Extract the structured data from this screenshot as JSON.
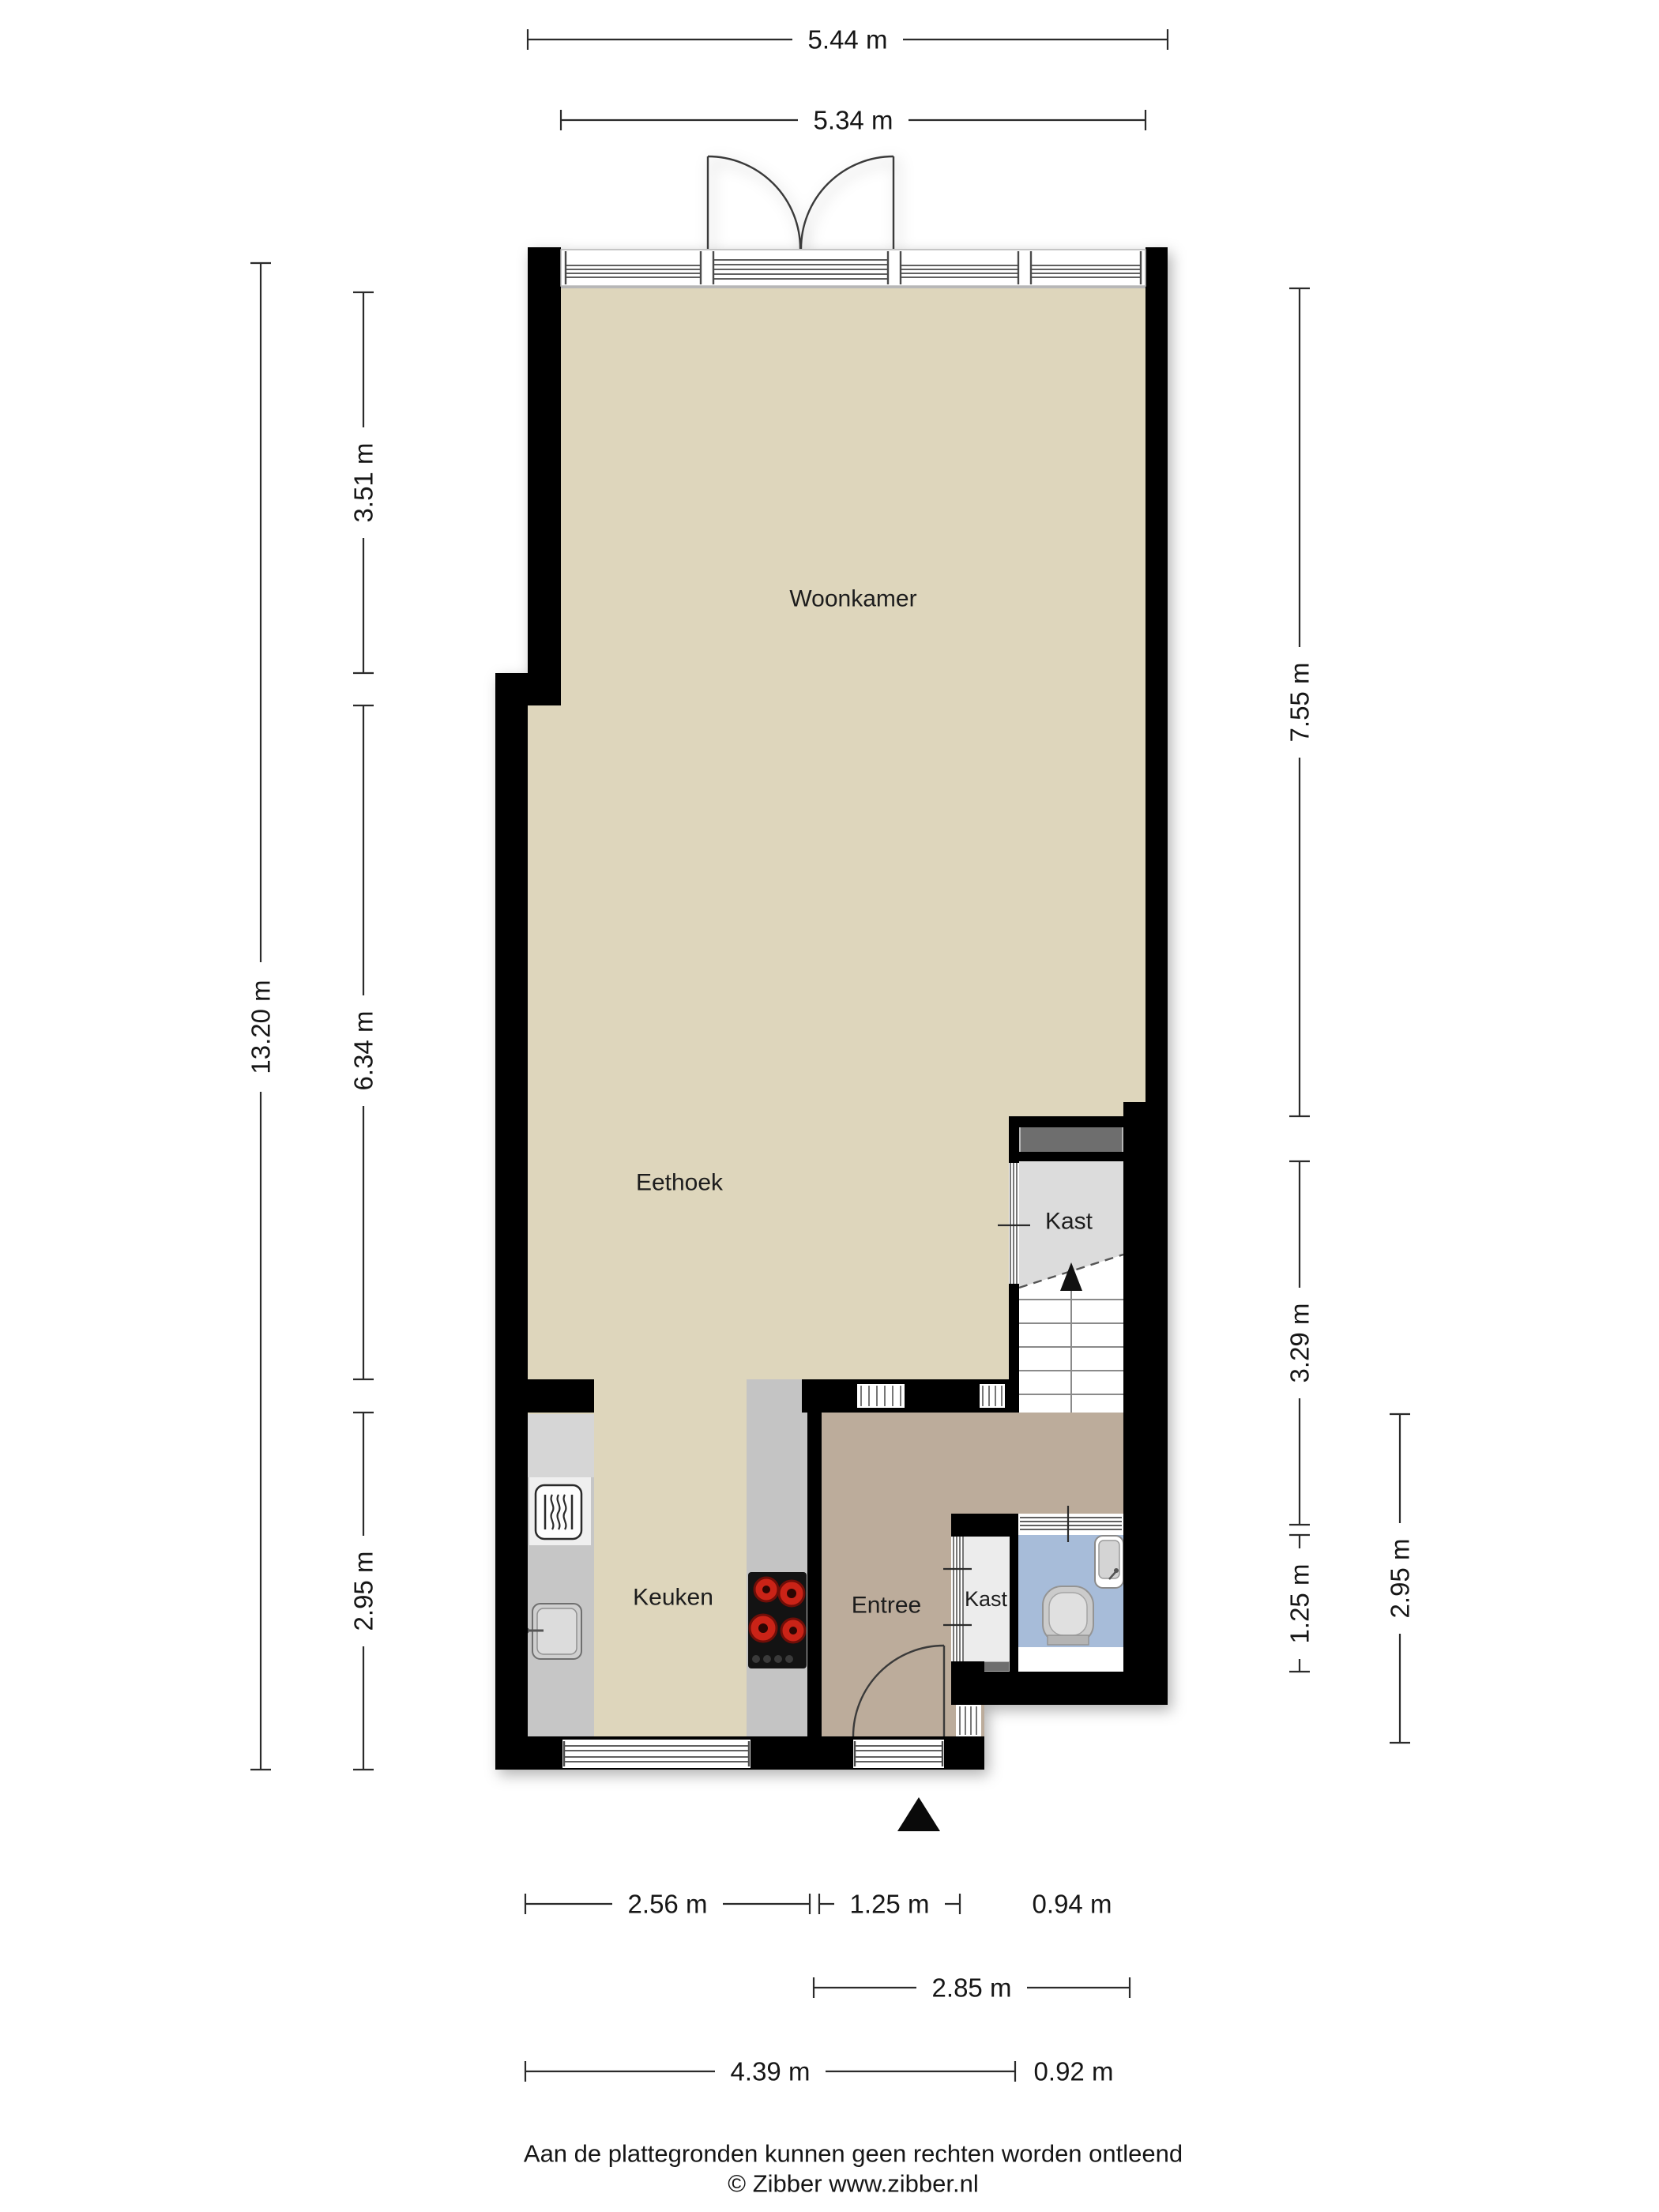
{
  "rooms": {
    "woonkamer": "Woonkamer",
    "eethoek": "Eethoek",
    "keuken": "Keuken",
    "entree": "Entree",
    "kast_large": "Kast",
    "kast_small": "Kast"
  },
  "dims": {
    "top": [
      {
        "label": "5.44 m"
      },
      {
        "label": "5.34 m"
      }
    ],
    "left": [
      {
        "label": "3.51 m"
      },
      {
        "label": "6.34 m"
      },
      {
        "label": "2.95 m"
      },
      {
        "label": "13.20 m"
      }
    ],
    "right": [
      {
        "label": "7.55 m"
      },
      {
        "label": "3.29 m"
      },
      {
        "label": "1.25 m"
      },
      {
        "label": "2.95 m"
      }
    ],
    "bottom": [
      {
        "label": "2.56 m"
      },
      {
        "label": "1.25 m"
      },
      {
        "label": "0.94 m"
      },
      {
        "label": "2.85 m"
      },
      {
        "label": "4.39 m"
      },
      {
        "label": "0.92 m"
      }
    ]
  },
  "footer": {
    "disclaimer": "Aan de plattegronden kunnen geen rechten worden ontleend",
    "credit": "© Zibber www.zibber.nl"
  },
  "colors": {
    "wall": "#000000",
    "floor_main": "#DED6BC",
    "floor_entree": "#BCAC9B",
    "floor_toilet": "#A7BCD9",
    "floor_closet": "#DCDCDC",
    "floor_closet_small": "#ECECEC",
    "counter": "#C6C6C6",
    "counter_light": "#D6D6D6",
    "counter_island": "#C4C4C4",
    "shelf": "#6E6E6E",
    "stairs": "#FFFFFF",
    "cooktop_panel": "#131313",
    "burner": "#CA2317",
    "appliance": "#EFEFEF"
  },
  "icons": [
    "double-door-icon",
    "entry-door-icon",
    "stairs-up-arrow-icon",
    "entrance-arrow-icon",
    "toilet-icon",
    "hand-basin-icon",
    "cooktop-icon",
    "oven-icon",
    "sink-icon",
    "closet-shelf-icon"
  ]
}
